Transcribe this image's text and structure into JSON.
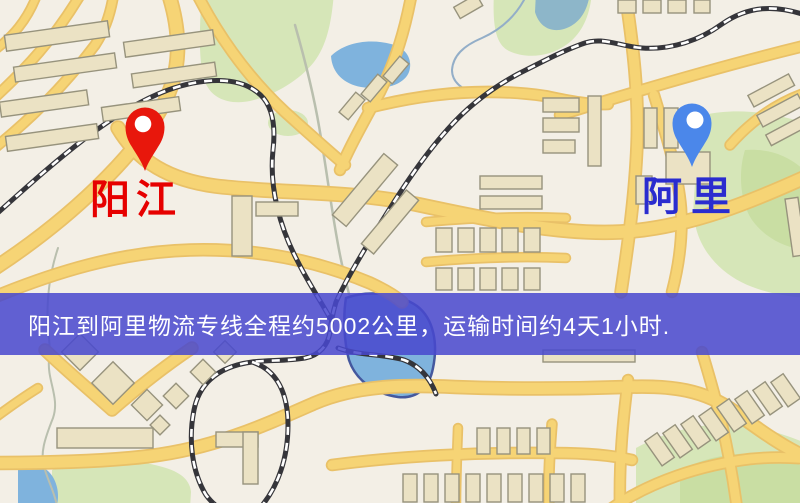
{
  "map": {
    "palette": {
      "background": "#f3efe6",
      "road_fill": "#f6d475",
      "road_casing": "#e9c168",
      "park_green": "#d6e6b8",
      "park_green_dark": "#c9dea3",
      "water_blue": "#7fb3dd",
      "water_teal": "#8db6c9",
      "water_edge": "#44589e",
      "building_fill": "#ebe2c4",
      "building_outline": "#97937d",
      "railway_dark": "#35353a",
      "railway_light": "#ffffff",
      "stream_gray": "#b9bfae",
      "stream_blue": "#93aec8",
      "pin_hole": "#ffffff"
    }
  },
  "markers": {
    "origin": {
      "label": "阳江",
      "pin_color": "#e8170c",
      "label_color": "#e60000"
    },
    "destination": {
      "label": "阿里",
      "pin_color": "#4b87ea",
      "label_color": "#2a2ccf"
    }
  },
  "banner": {
    "text": "阳江到阿里物流专线全程约5002公里，运输时间约4天1小时.",
    "background": "rgba(72,72,206,0.86)",
    "text_color": "#ffffff"
  },
  "route": {
    "origin": "阳江",
    "destination": "阿里",
    "distance_text": "约5002公里",
    "duration_text": "约4天1小时"
  }
}
